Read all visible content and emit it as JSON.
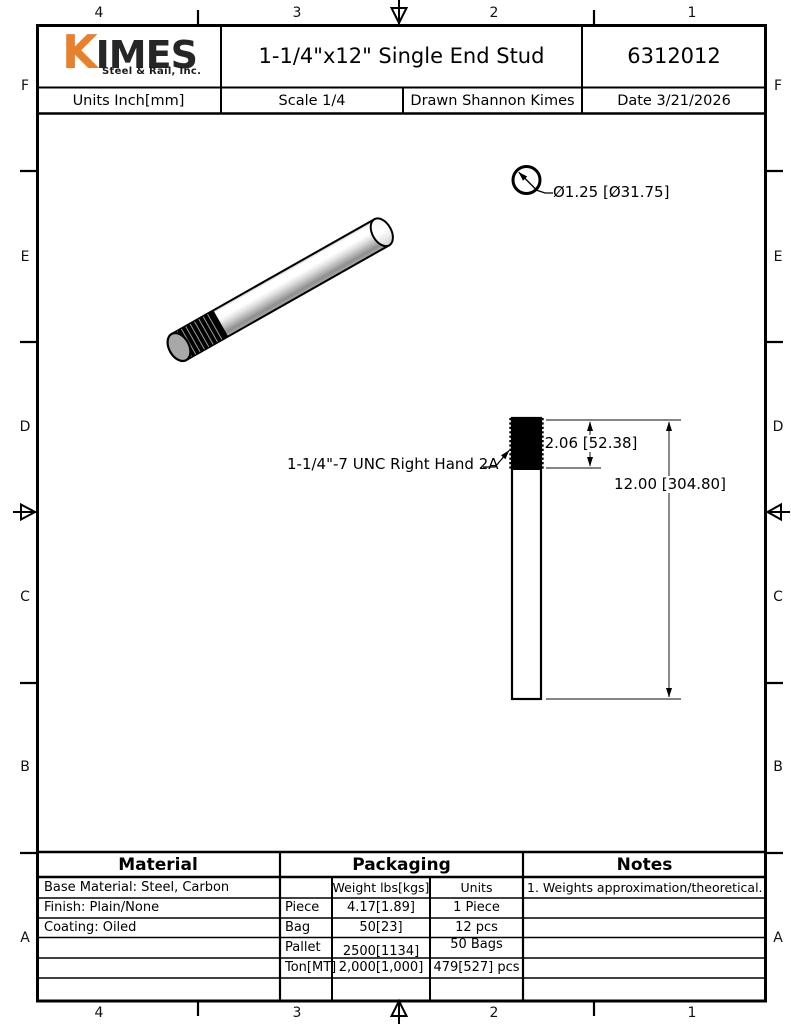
{
  "sheet": {
    "zone_columns": [
      "4",
      "3",
      "2",
      "1"
    ],
    "zone_rows": [
      "F",
      "E",
      "D",
      "C",
      "B",
      "A"
    ]
  },
  "title_block": {
    "logo_k": "K",
    "logo_imes": "IMES",
    "logo_tagline": "Steel & Rail, Inc.",
    "title": "1-1/4\"x12\" Single End Stud",
    "part_number": "6312012",
    "units": "Units Inch[mm]",
    "scale": "Scale 1/4",
    "drawn": "Drawn Shannon Kimes",
    "date": "Date 3/21/2026"
  },
  "annotations": {
    "diameter": "Ø1.25 [Ø31.75]",
    "thread_spec": "1-1/4\"-7 UNC Right Hand 2A",
    "thread_length": "2.06 [52.38]",
    "overall_length": "12.00 [304.80]"
  },
  "material_table": {
    "header": "Material",
    "rows": [
      "Base Material: Steel, Carbon",
      "Finish: Plain/None",
      "Coating: Oiled"
    ]
  },
  "packaging_table": {
    "header": "Packaging",
    "weight_header": "Weight lbs[kgs]",
    "units_header": "Units",
    "rows": [
      {
        "label": "Piece",
        "weight": "4.17[1.89]",
        "units": "1 Piece"
      },
      {
        "label": "Bag",
        "weight": "50[23]",
        "units": "12 pcs"
      },
      {
        "label": "Pallet",
        "weight": "2500[1134]",
        "units": "50 Bags"
      },
      {
        "label": "Ton[MT]",
        "weight": "2,000[1,000]",
        "units": "479[527] pcs"
      }
    ]
  },
  "notes_table": {
    "header": "Notes",
    "rows": [
      "1. Weights approximation/theoretical."
    ]
  },
  "colors": {
    "logo_orange": "#E8812C",
    "logo_dark": "#262626",
    "line_black": "#000000"
  }
}
